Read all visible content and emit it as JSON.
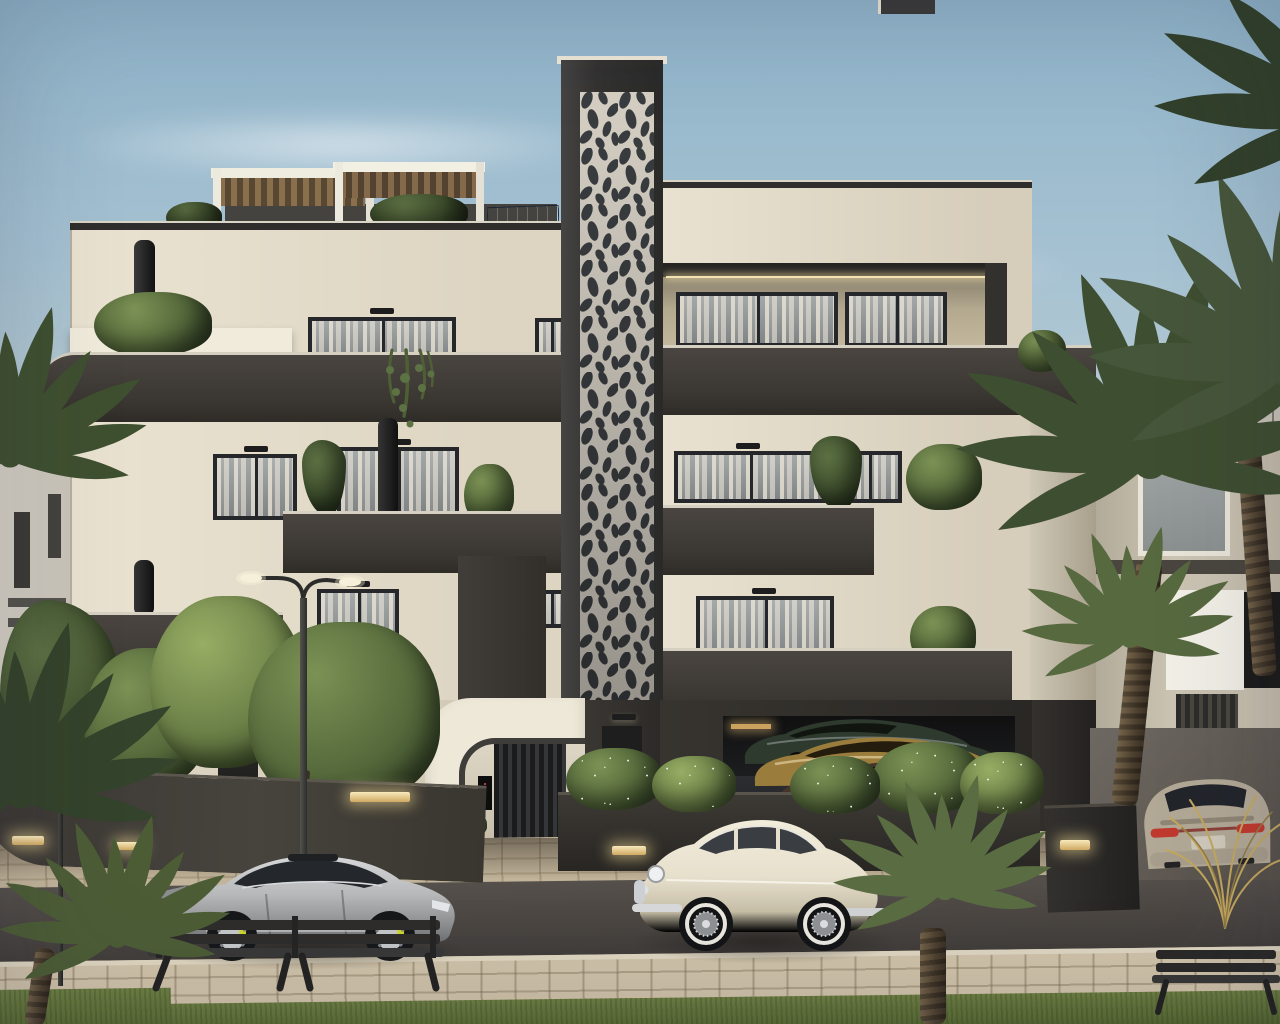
{
  "scene_type": "architectural-exterior-render",
  "subject": "modern-black-and-white-apartment-building-at-dusk",
  "colors": {
    "sky-top": "#8fb3c9",
    "sky-horizon": "#e4d7c6",
    "wall-cream": "#e3dcca",
    "wall-cream-lit": "#ece5d3",
    "band-brown": "#3b3733",
    "coping": "#d6d0c2",
    "frame": "#26272a",
    "pattern-bg": "#d5cfc4",
    "pattern-blob": "#3a3d40",
    "wood": "#8a6f4d",
    "solar": "#2c3850",
    "asphalt": "#4d4844",
    "paver": "#c2b49a",
    "grass-green": "#5f7238",
    "palm-green": "#46563a",
    "car-silver": "#b7b8ba",
    "car-cream": "#e7e0cd",
    "car-beige": "#b2a896",
    "garage-car-green": "#2e3a2d",
    "garage-car-gold": "#9a7d3c",
    "garage-car-brown": "#46332a",
    "caliper-yellow": "#cdd52e",
    "taillight-red": "#c0392e",
    "warm-light": "#f3e3b3"
  },
  "building": {
    "name": "modern-apartment-building",
    "floors": 4,
    "features": [
      "perforated-ornamental-tower",
      "rooftop-pergolas",
      "solar-panels",
      "curved-charcoal-balcony-bands",
      "sheer-curtain-windows",
      "hanging-balcony-plants",
      "arched-entrance-canopy",
      "intercom-panel",
      "slatted-entrance-door",
      "under-building-parking-garage",
      "planter-boxes-with-white-flowers",
      "wall-downlights"
    ]
  },
  "vehicles": [
    {
      "name": "silver-sports-sedan",
      "color": "#b7b8ba",
      "details": [
        "rear-spoiler",
        "yellow-brake-calipers",
        "dark-glass-roof"
      ]
    },
    {
      "name": "cream-classic-saloon",
      "color": "#e7e0cd",
      "details": [
        "wire-wheels",
        "whitewall-tires",
        "chrome-trim"
      ]
    },
    {
      "name": "beige-sedan-rear-view",
      "color": "#b2a896",
      "details": [
        "red-taillights",
        "driveway-ramp"
      ]
    },
    {
      "name": "garage-car-dark-green",
      "color": "#2e3a2d"
    },
    {
      "name": "garage-car-gold",
      "color": "#9a7d3c"
    },
    {
      "name": "garage-car-brown",
      "color": "#46332a"
    }
  ],
  "street": [
    "double-arm-street-lamp",
    "small-garden-lamp",
    "wooden-bench-left",
    "wooden-bench-right",
    "paver-forecourt",
    "asphalt-road",
    "paver-sidewalk",
    "grass-verge",
    "curved-garden-wall-with-recessed-lights",
    "right-garden-wall-with-recessed-light"
  ],
  "vegetation": [
    "palm-cluster-right",
    "palm-fronds-top-right",
    "foreground-palm",
    "palm-fronds-left",
    "bottom-left-palm",
    "front-garden-trees",
    "rooftop-shrubs",
    "balcony-hanging-vines",
    "planter-shrubs-white-flowers",
    "dry-grass-tuft"
  ],
  "background": [
    "white-townhouses-left",
    "neighbor-building-right-glass-railing",
    "soft-clouds",
    "dusk-haze"
  ]
}
